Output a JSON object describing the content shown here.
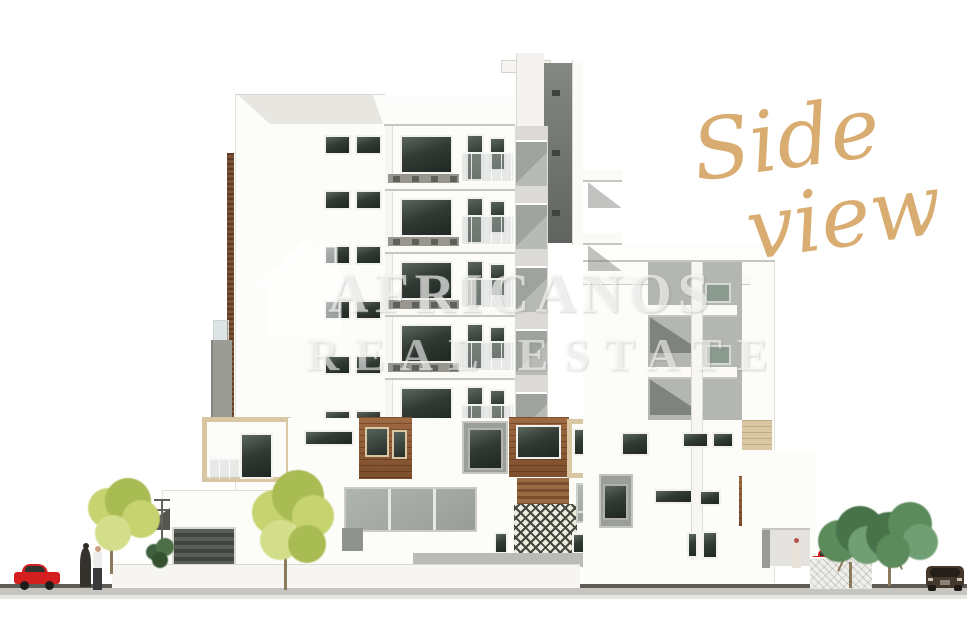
{
  "scene": {
    "type": "architectural side elevation rendering of a residential apartment building",
    "annotation": {
      "line1": "Side",
      "line2": "view"
    },
    "watermark": {
      "brand": "AFRICANOS",
      "tagline": "REAL ESTATE",
      "icon": "house-icon"
    },
    "objects": {
      "trees_light_green": 2,
      "trees_dark_green": 2,
      "cars": 3,
      "people": 3
    },
    "palette": {
      "accent_gold": "#d9ad72",
      "watermark": "rgba(255,255,255,0.62)",
      "wood": "#7c4e2c",
      "wood_light": "#a06a42",
      "beige": "#d9c6a2",
      "glass_dark": "#2b332d",
      "glass_gray": "#8d9591",
      "facade_gray": "#b4b7b1",
      "tower_dark": "#6d716b",
      "tree_light": "#c6d36f",
      "tree_light_dark": "#a9bc53",
      "tree_dark": "#5b8a5b",
      "tree_dark_deep": "#47724a",
      "trunk": "#8c7a5c",
      "car_red": "#d41f1f",
      "car_dark": "#45372c",
      "road_dark": "#5d5c57",
      "road_light": "#c6c5bf"
    }
  }
}
